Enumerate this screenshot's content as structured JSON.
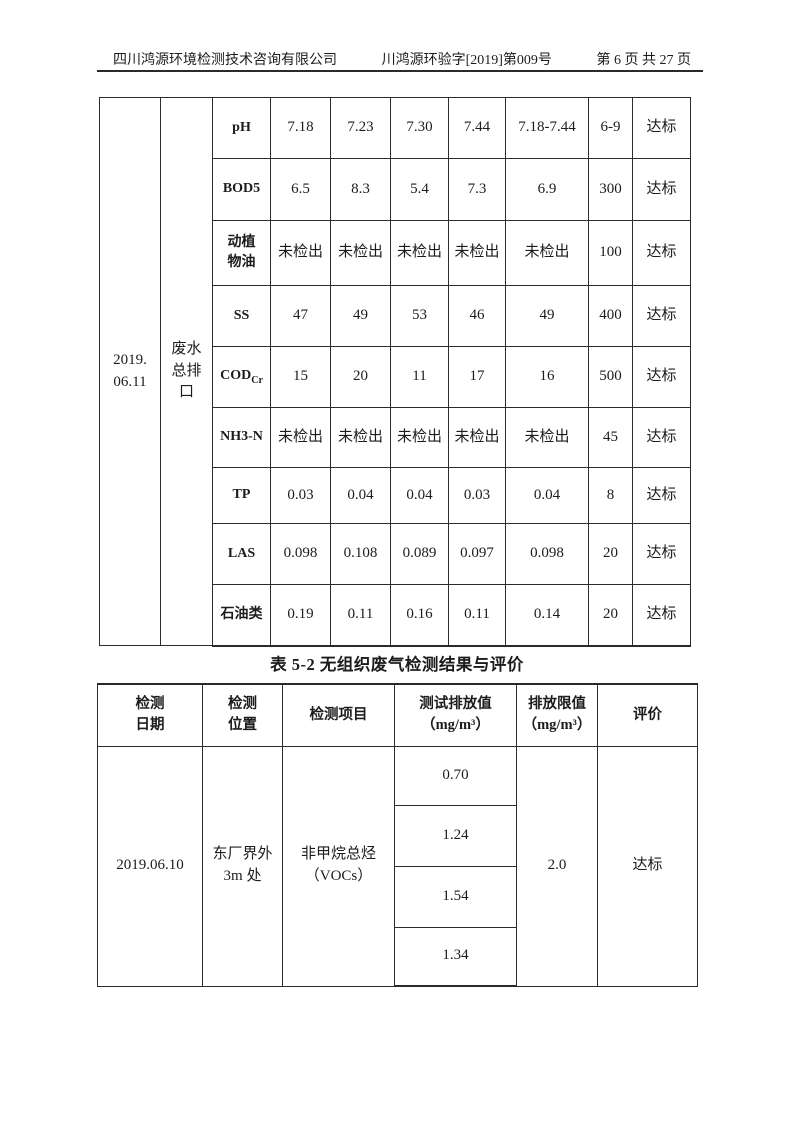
{
  "page_header": {
    "company": "四川鸿源环境检测技术咨询有限公司",
    "doc_number": "川鸿源环验字[2019]第009号",
    "page_info": "第 6 页 共 27 页"
  },
  "table1": {
    "date": "2019.\n06.11",
    "location": "废水\n总排\n口",
    "rows": [
      {
        "item": "pH",
        "values": [
          "7.18",
          "7.23",
          "7.30",
          "7.44"
        ],
        "avg": "7.18-7.44",
        "limit": "6-9",
        "eval": "达标"
      },
      {
        "item": "BOD5",
        "values": [
          "6.5",
          "8.3",
          "5.4",
          "7.3"
        ],
        "avg": "6.9",
        "limit": "300",
        "eval": "达标"
      },
      {
        "item": "动植\n物油",
        "values": [
          "未检出",
          "未检出",
          "未检出",
          "未检出"
        ],
        "avg": "未检出",
        "limit": "100",
        "eval": "达标"
      },
      {
        "item": "SS",
        "values": [
          "47",
          "49",
          "53",
          "46"
        ],
        "avg": "49",
        "limit": "400",
        "eval": "达标"
      },
      {
        "item": "COD",
        "item_sub": "Cr",
        "values": [
          "15",
          "20",
          "11",
          "17"
        ],
        "avg": "16",
        "limit": "500",
        "eval": "达标"
      },
      {
        "item": "NH3-N",
        "values": [
          "未检出",
          "未检出",
          "未检出",
          "未检出"
        ],
        "avg": "未检出",
        "limit": "45",
        "eval": "达标"
      },
      {
        "item": "TP",
        "values": [
          "0.03",
          "0.04",
          "0.04",
          "0.03"
        ],
        "avg": "0.04",
        "limit": "8",
        "eval": "达标"
      },
      {
        "item": "LAS",
        "values": [
          "0.098",
          "0.108",
          "0.089",
          "0.097"
        ],
        "avg": "0.098",
        "limit": "20",
        "eval": "达标"
      },
      {
        "item": "石油类",
        "values": [
          "0.19",
          "0.11",
          "0.16",
          "0.11"
        ],
        "avg": "0.14",
        "limit": "20",
        "eval": "达标"
      }
    ]
  },
  "table2": {
    "title": "表 5-2 无组织废气检测结果与评价",
    "headers": {
      "date": "检测\n日期",
      "location": "检测\n位置",
      "item": "检测项目",
      "measured": "测试排放值\n（mg/m³）",
      "limit": "排放限值\n（mg/m³）",
      "eval": "评价"
    },
    "row": {
      "date": "2019.06.10",
      "location": "东厂界外\n3m 处",
      "item": "非甲烷总烃\n（VOCs）",
      "values": [
        "0.70",
        "1.24",
        "1.54",
        "1.34"
      ],
      "limit": "2.0",
      "eval": "达标"
    }
  }
}
